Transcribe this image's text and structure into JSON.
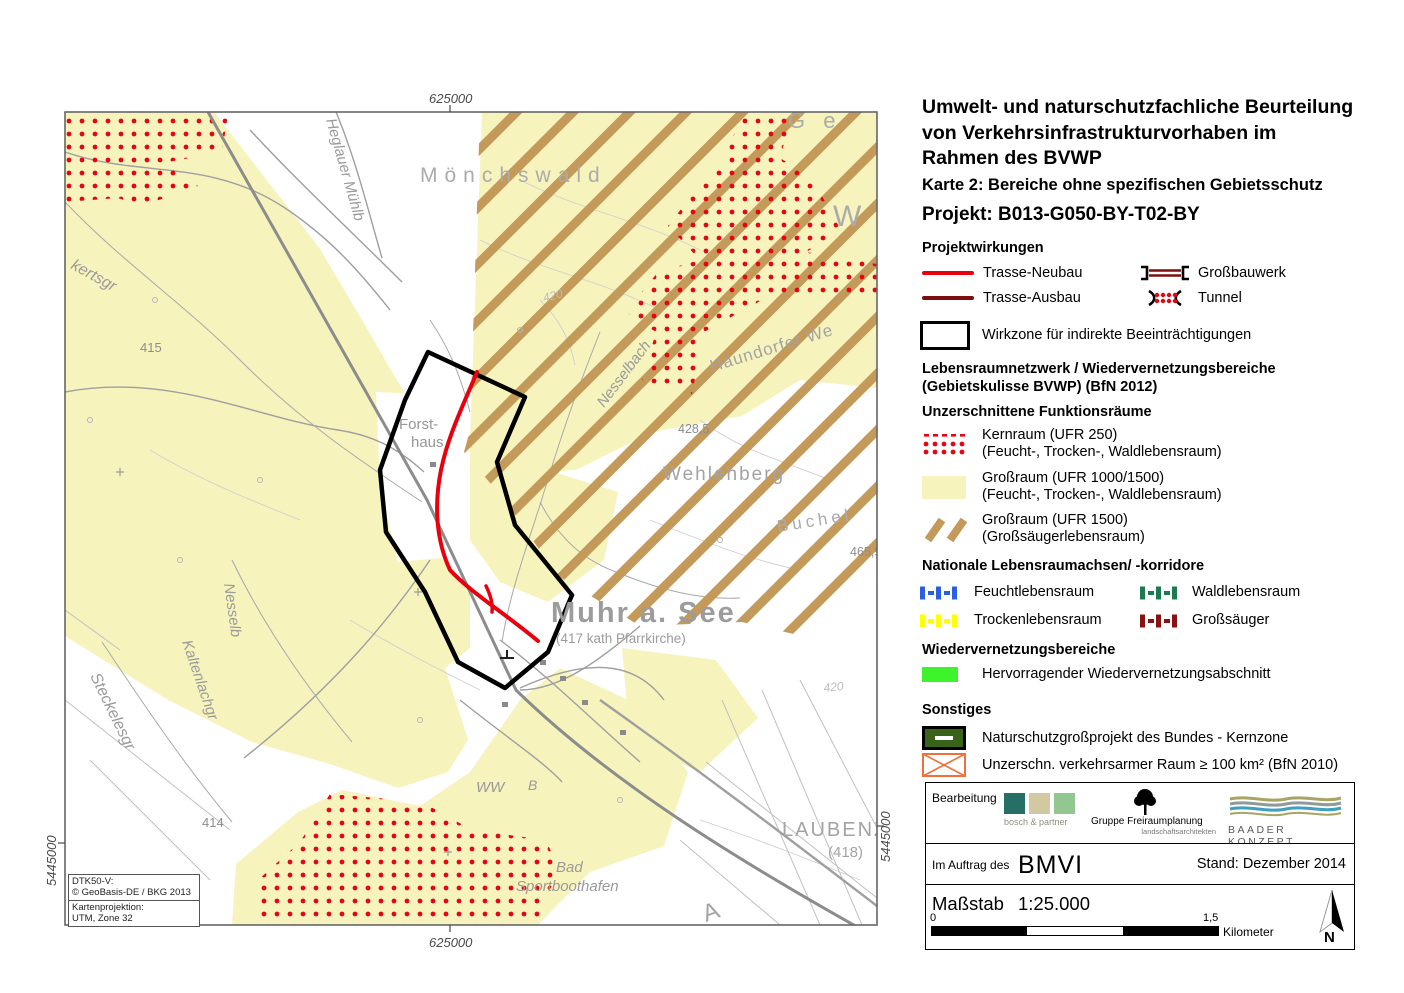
{
  "header": {
    "title_line1": "Umwelt- und naturschutzfachliche Beurteilung",
    "title_line2": "von Verkehrsinfrastrukturvorhaben im",
    "title_line3": "Rahmen des BVWP",
    "subtitle": "Karte 2: Bereiche ohne spezifischen Gebietsschutz",
    "project": "Projekt: B013-G050-BY-T02-BY"
  },
  "legend": {
    "projektwirkungen_heading": "Projektwirkungen",
    "trasse_neubau": "Trasse-Neubau",
    "grossbauwerk": "Großbauwerk",
    "trasse_ausbau": "Trasse-Ausbau",
    "tunnel": "Tunnel",
    "wirkzone": "Wirkzone für indirekte Beeinträchtigungen",
    "lebensraum_heading1": "Lebensraumnetzwerk / Wiedervernetzungsbereiche",
    "lebensraum_heading2": "(Gebietskulisse BVWP) (BfN 2012)",
    "funktionsraeume_heading": "Unzerschnittene Funktionsräume",
    "kernraum_line1": "Kernraum (UFR 250)",
    "kernraum_line2": "(Feucht-, Trocken-, Waldlebensraum)",
    "grossraum1000_line1": "Großraum (UFR 1000/1500)",
    "grossraum1000_line2": "(Feucht-, Trocken-, Waldlebensraum)",
    "grossraum1500_line1": "Großraum (UFR 1500)",
    "grossraum1500_line2": "(Großsäugerlebensraum)",
    "achsen_heading": "Nationale Lebensraumachsen/ -korridore",
    "feucht": "Feuchtlebensraum",
    "wald": "Waldlebensraum",
    "trocken": "Trockenlebensraum",
    "grosssaeuger": "Großsäuger",
    "wieder_heading": "Wiedervernetzungsbereiche",
    "hervorragend": "Hervorragender Wiedervernetzungsabschnitt",
    "sonstiges_heading": "Sonstiges",
    "naturschutz": "Naturschutzgroßprojekt des Bundes - Kernzone",
    "verkehrsarm": "Unzerschn. verkehrsarmer Raum ≥ 100 km² (BfN 2010)"
  },
  "credits_block": {
    "bearbeitung": "Bearbeitung",
    "logo1": "bosch & partner",
    "logo2_line1": "Gruppe Freiraumplanung",
    "logo2_line2": "landschaftsarchitekten",
    "logo3": "BAADER KONZEPT",
    "auftrag": "Im Auftrag des",
    "bmvi": "BMVI",
    "stand": "Stand: Dezember 2014"
  },
  "scalebar": {
    "massstab_label": "Maßstab",
    "ratio": "1:25.000",
    "tick0": "0",
    "tick15": "1,5",
    "unit": "Kilometer",
    "north": "N"
  },
  "map": {
    "coords": {
      "top": "625000",
      "bottom": "625000",
      "left": "5445000",
      "right": "5445000"
    },
    "source": {
      "l1": "DTK50-V:",
      "l2": "© GeoBasis-DE / BKG 2013",
      "l3": "Kartenprojektion:",
      "l4": "UTM, Zone 32"
    },
    "labels": {
      "moenchswald": "Mönchswald",
      "ge": "G e",
      "w_label": "W",
      "heglauer": "Heglauer Mühlb",
      "kertsgr": "kertsgr",
      "h415": "415",
      "forst1": "Forst-",
      "forst2": "haus",
      "nesselbach": "Nesselbach",
      "haundorfer": "Haundorfer We",
      "c420a": "420",
      "h4285": "428,5",
      "wehlenberg": "Wehlenberg",
      "buchel": "Buchel",
      "h4659": "465,9",
      "nesselb": "Nesselb",
      "kaltenlachgr": "Kaltenlachgr",
      "steckelesgr": "Steckelesgr",
      "h414": "414",
      "muhr": "Muhr a. See",
      "muhr_sub": "(417 kath Pfarrkirche)",
      "ww": "WW",
      "b_label": "B",
      "bad": "Bad",
      "sportboothafen": "Sportboothafen",
      "laubenz": "LAUBENZ",
      "l418": "(418)",
      "c420b": "420",
      "a_label": "A"
    }
  },
  "colors": {
    "trasse_neubau": "#e8000f",
    "trasse_ausbau": "#7d0f0f",
    "kernraum_dots": "#e30613",
    "grossraum_yellow": "#f7f3bd",
    "grossraum_hatch": "#c49a5a",
    "feucht_blue": "#2a5fe0",
    "wald_green": "#1d7a50",
    "trocken_yellow": "#ffff00",
    "grosssaeuger_red": "#8b1212",
    "wieder_green": "#3cf32c",
    "naturschutz_green": "#38641a",
    "verkehrsarm_orange": "#f0703c"
  }
}
